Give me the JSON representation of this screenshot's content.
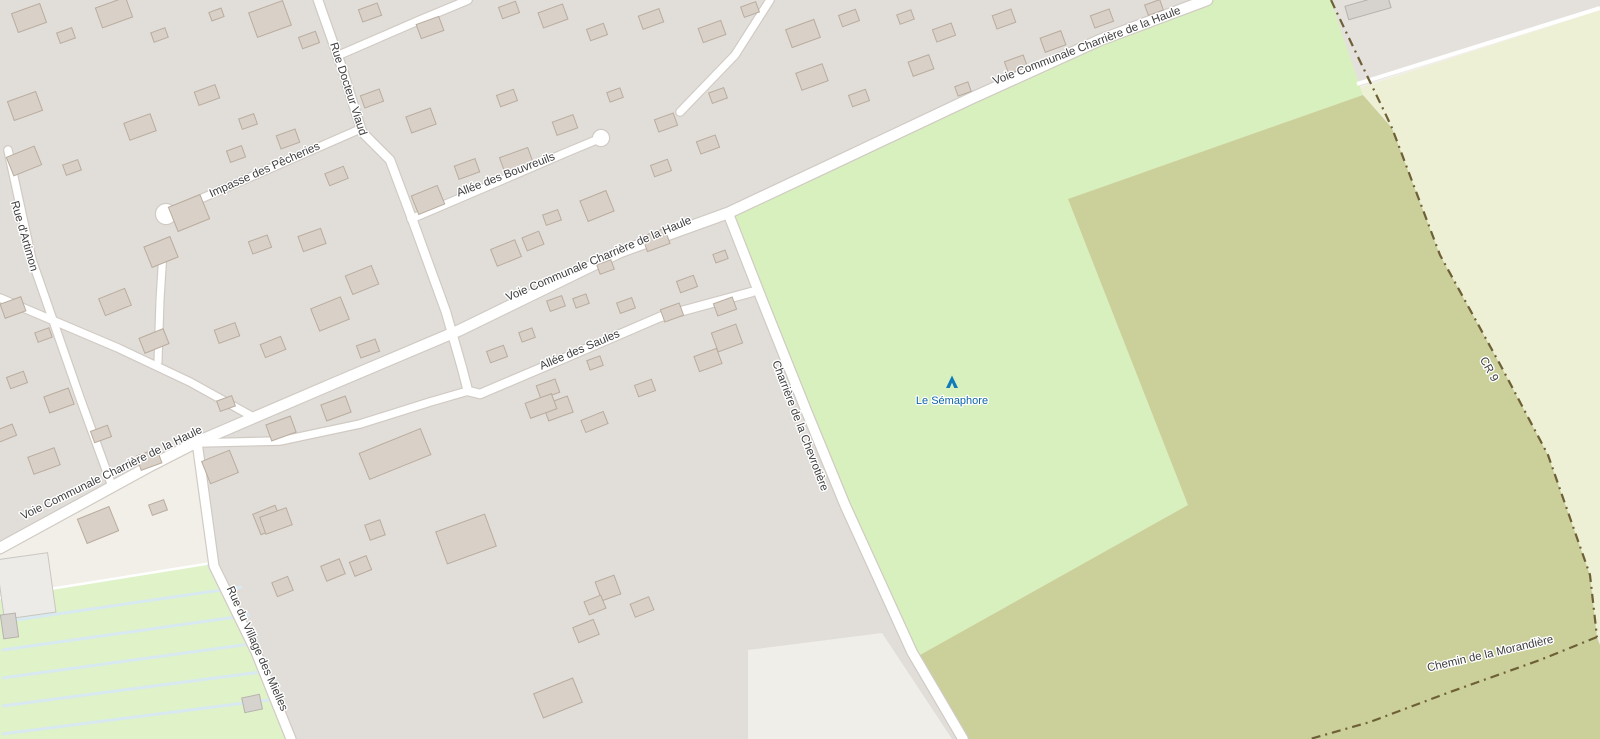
{
  "map": {
    "description": "OpenStreetMap-style street map with residential area, meadow, scrub, farmland and a campsite POI",
    "colors": {
      "land": "#f2efe9",
      "residential": "#e1deda",
      "residential_wedge": "#e4e1dc",
      "meadow": "#d7f0bd",
      "campsite": "#dff2c8",
      "campsite_stripe": "#d8e9f1",
      "scrub": "#cbcf99",
      "farmland": "#eef0d6",
      "cream": "#f2efe9",
      "road_fill": "#ffffff",
      "road_casing": "#d0cac3",
      "track": "#6e6036",
      "building_fill": "#d9d0c7",
      "building_stroke": "#b9ac9e",
      "gray_building_fill": "#d6d3ce",
      "gray_building_stroke": "#b5b2ad",
      "white_building_fill": "#edebe7",
      "white_building_stroke": "#c9c6c1",
      "street_label": "#3d3d3d",
      "poi_label_blue": "#0b63a8",
      "poi_icon_blue": "#0e7cba"
    },
    "street_labels": [
      {
        "id": "rue-docteur-viaud",
        "text": "Rue Docteur Viaud",
        "x": 345,
        "y": 90,
        "rotation": 72
      },
      {
        "id": "impasse-des-pecheries",
        "text": "Impasse des Pêcheries",
        "x": 266,
        "y": 173,
        "rotation": -24
      },
      {
        "id": "allee-des-bouvreuils",
        "text": "Allée des Bouvreuils",
        "x": 507,
        "y": 178,
        "rotation": -21
      },
      {
        "id": "voie-communale-charriere-de-la-haule-ne",
        "text": "Voie Communale Charrière de la Haule",
        "x": 1088,
        "y": 49,
        "rotation": -21
      },
      {
        "id": "voie-communale-charriere-de-la-haule-mid",
        "text": "Voie Communale Charrière de la Haule",
        "x": 600,
        "y": 262,
        "rotation": -23
      },
      {
        "id": "voie-communale-charriere-de-la-haule-sw",
        "text": "Voie Communale Charrière de la Haule",
        "x": 113,
        "y": 476,
        "rotation": -26
      },
      {
        "id": "allee-des-saules",
        "text": "Allée des Saules",
        "x": 581,
        "y": 353,
        "rotation": -23
      },
      {
        "id": "rue-d-artimon",
        "text": "Rue d'Artimon",
        "x": 21,
        "y": 237,
        "rotation": 74
      },
      {
        "id": "charriere-de-la-chevrotiere",
        "text": "Charrière de la Chevrotière",
        "x": 797,
        "y": 427,
        "rotation": 69
      },
      {
        "id": "rue-du-village-des-mielles",
        "text": "Rue du Village des Mielles",
        "x": 254,
        "y": 650,
        "rotation": 66
      },
      {
        "id": "cr-9",
        "text": "CR 9",
        "x": 1486,
        "y": 371,
        "rotation": 61
      },
      {
        "id": "chemin-de-la-morandiere",
        "text": "Chemin de la Morandière",
        "x": 1491,
        "y": 657,
        "rotation": -13
      }
    ],
    "poi": {
      "name": "Le Sémaphore",
      "type": "campsite",
      "label_x": 952,
      "label_y": 404,
      "icon_x": 952,
      "icon_y": 382
    }
  }
}
